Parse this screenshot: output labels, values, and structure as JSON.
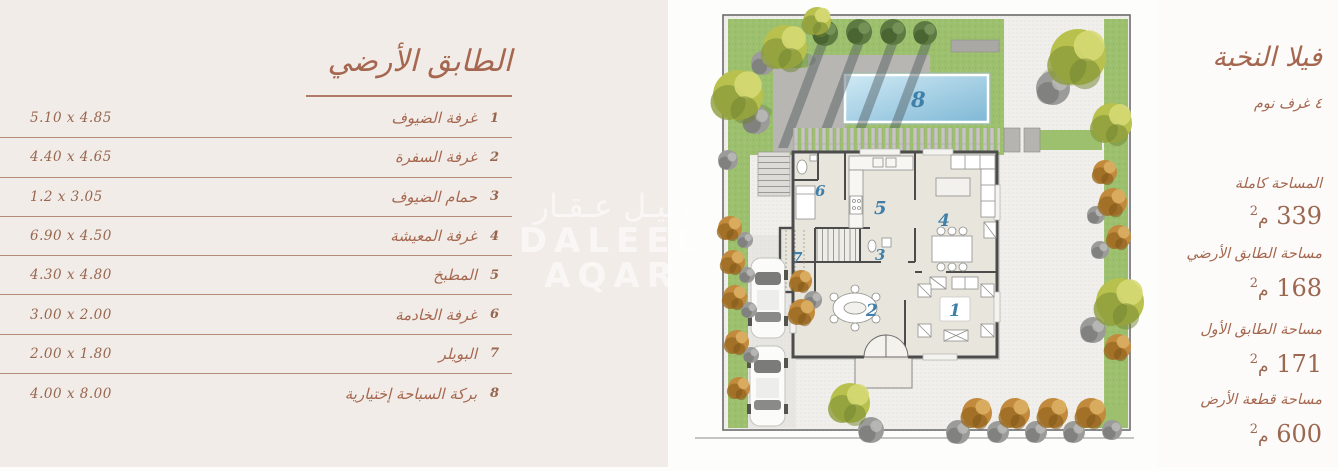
{
  "left_panel": {
    "title": "الطابق الأرضي",
    "rows": [
      {
        "num": "1",
        "name": "غرفة الضيوف",
        "dim": "5.10 x 4.85"
      },
      {
        "num": "2",
        "name": "غرفة السفرة",
        "dim": "4.40 x 4.65"
      },
      {
        "num": "3",
        "name": "حمام الضيوف",
        "dim": "1.2 x 3.05"
      },
      {
        "num": "4",
        "name": "غرفة المعيشة",
        "dim": "6.90 x 4.50"
      },
      {
        "num": "5",
        "name": "المطبخ",
        "dim": "4.30 x 4.80"
      },
      {
        "num": "6",
        "name": "غرفة الخادمة",
        "dim": "3.00 x 2.00"
      },
      {
        "num": "7",
        "name": "البويلر",
        "dim": "2.00 x 1.80"
      },
      {
        "num": "8",
        "name": "بركة السباحة إختيارية",
        "dim": "4.00 x 8.00"
      }
    ]
  },
  "right_panel": {
    "title": "فيلا النخبة",
    "bedrooms": "٤ غرف نوم",
    "stats": [
      {
        "label": "المساحة كاملة",
        "value": "339",
        "unit": "م",
        "sup": "2"
      },
      {
        "label": "مساحة الطابق الأرضي",
        "value": "168",
        "unit": "م",
        "sup": "2"
      },
      {
        "label": "مساحة الطابق الأول",
        "value": "171",
        "unit": "م",
        "sup": "2"
      },
      {
        "label": "مساحة قطعة الأرض",
        "value": "600",
        "unit": "م",
        "sup": "2"
      }
    ]
  },
  "plan": {
    "labels": {
      "n1": "1",
      "n2": "2",
      "n3": "3",
      "n4": "4",
      "n5": "5",
      "n6": "6",
      "n7": "7",
      "n8": "8"
    }
  },
  "watermark": {
    "ar": "دليـل عـقـار",
    "en": "DALEEL AQAR"
  },
  "colors": {
    "panel_beige": "#f2ece8",
    "accent_brown": "#a5674f",
    "label_blue": "#3f7fa8",
    "grass_green": "#9dc06e",
    "pool_blue": "#8fc3de"
  }
}
